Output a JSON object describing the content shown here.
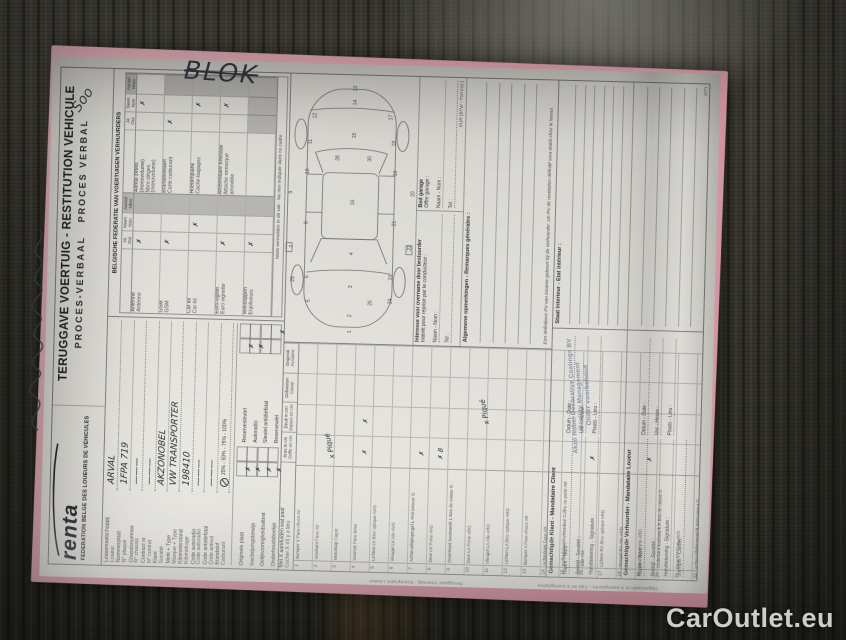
{
  "watermark": "CarOutlet.eu",
  "margin_notes": {
    "blok": "BLOK",
    "soo": "Soo"
  },
  "header": {
    "logo": "renta",
    "federation": "FEDERATION BELGE DES LOUEURS DE VÉHICULES",
    "title": "TERUGGAVE VOERTUIG - RESTITUTION VEHICULE",
    "subtitle_nl": "PROCES-VERBAAL",
    "subtitle_fr": "PROCES VERBAL"
  },
  "vehicle_fields": [
    {
      "nl": "Leasemaatschappij",
      "fr": "Loueur",
      "value": "ARVAL"
    },
    {
      "nl": "Nummerplaat",
      "fr": "N° plaque",
      "value": "1FPA 719"
    },
    {
      "nl": "Chassisnummer",
      "fr": "N° chassis",
      "value": "———"
    },
    {
      "nl": "Contract nr",
      "fr": "N° contrat",
      "value": "———"
    },
    {
      "nl": "Klant",
      "fr": "Société",
      "value": "AKZONOBEL"
    },
    {
      "nl": "Merk + Type",
      "fr": "Marque + Type",
      "value": "VW TRANSPORTER"
    },
    {
      "nl": "Kilometerstand",
      "fr": "Kilométrage",
      "value": "198410"
    },
    {
      "nl": "Code autoradio",
      "fr": "Code autoradio",
      "value": "———"
    },
    {
      "nl": "Code antidiefstal",
      "fr": "Code antivol",
      "value": "———"
    },
    {
      "nl": "Brandstof",
      "fr": "Carburant",
      "value": "",
      "fuel": "25% - 50% - 75% - 100%"
    }
  ],
  "documents": {
    "items": [
      {
        "nl": "Originele plaat",
        "fr": "Plaque officielle",
        "ja": "✗",
        "neen": ""
      },
      {
        "nl": "Inschrijvingsbewijs",
        "fr": "Cert. d'immatriculation",
        "ja": "✗",
        "neen": ""
      },
      {
        "nl": "Gelijkvormigheidsattest",
        "fr": "Certif. de conformité",
        "ja": "✗",
        "neen": ""
      },
      {
        "nl": "Onderhoudsboekje",
        "fr": "Carnet d'entretien",
        "ja": "✗",
        "neen": ""
      },
      {
        "nl": "Reservesleutel",
        "fr": "Clé de réserve",
        "ja": "✗",
        "neen": ""
      },
      {
        "nl": "Autoradio",
        "fr": "Autoradio",
        "ja": "✗",
        "neen": ""
      },
      {
        "nl": "Sleutel antidiefstal",
        "fr": "Clé antivol",
        "ja": "",
        "neen": ""
      },
      {
        "nl": "Reservewiel",
        "fr": "Roue de réserve",
        "ja": "",
        "neen": "✗"
      }
    ]
  },
  "federation": {
    "title": "BELGISCHE FEDERATIE VAN VOERTUIGEN VERHUURDERS",
    "ja": "Ja",
    "oui": "Oui",
    "neen": "Neen",
    "non": "Non",
    "aantal": "Aantal",
    "nbre": "Nbre",
    "group_a": [
      {
        "nl": "Antenne",
        "fr": "Antenne",
        "ja": "✗",
        "neen": "",
        "aantal": "",
        "count": false
      },
      {
        "nl": "GSM",
        "fr": "GSM",
        "ja": "✗",
        "neen": "",
        "aantal": "",
        "count": false
      },
      {
        "nl": "Car kit",
        "fr": "Car kit",
        "ja": "",
        "neen": "✗",
        "aantal": "",
        "count": false
      },
      {
        "nl": "Euro-vignet",
        "fr": "Euro vignette",
        "ja": "✗",
        "neen": "",
        "aantal": "",
        "count": false
      },
      {
        "nl": "Wieldoppen",
        "fr": "Enjoliveurs",
        "ja": "✗",
        "neen": "",
        "aantal": "",
        "count": false
      }
    ],
    "group_b": [
      {
        "nl": "Aantal zetels (monovolume)",
        "fr": "Nbre sièges (monovolume)",
        "ja": "",
        "neen": "✗",
        "aantal": "",
        "count": true
      },
      {
        "nl": "Brandstofkaart",
        "fr": "Carte carburant",
        "ja": "✗",
        "neen": "",
        "aantal": "",
        "count": false
      },
      {
        "nl": "Hoedenplank",
        "fr": "Cache-bagages",
        "ja": "",
        "neen": "✗",
        "aantal": "",
        "count": false
      },
      {
        "nl": "Afneembare trekhaak",
        "fr": "Attache remorque amovible",
        "ja": "",
        "neen": "✗",
        "aantal": "",
        "count": false
      }
    ],
    "note": "Niets vermelden in dit vak - Ne rien indiquer dans ce cadre"
  },
  "damage": {
    "instruction_nl": "Met X aanduiden wat past",
    "instruction_fr": "Cocher X s'il y a lieu",
    "cols": [
      {
        "nl": "Kras in cm",
        "fr": "Griffe en cm"
      },
      {
        "nl": "Deuk in cm",
        "fr": "Impact en cm"
      },
      {
        "nl": "Gebarsten",
        "fr": "Cassé"
      },
      {
        "nl": "Ongeval",
        "fr": "Accident"
      }
    ],
    "note_windshield": "x Piqué",
    "note_mirror": "x Piqué",
    "rows": [
      {
        "n": "1",
        "nl": "Bumper V",
        "fr": "Pare-chocs AV",
        "m": [
          "",
          "",
          "",
          ""
        ]
      },
      {
        "n": "2",
        "nl": "Voorkant",
        "fr": "Face AV",
        "m": [
          "",
          "",
          "",
          ""
        ]
      },
      {
        "n": "3",
        "nl": "Motorkap",
        "fr": "Capot",
        "m": [
          "",
          "",
          "",
          ""
        ]
      },
      {
        "n": "4",
        "nl": "Voorruit",
        "fr": "Pare-brise",
        "m": [
          "✗",
          "✗",
          "",
          ""
        ]
      },
      {
        "n": "5",
        "nl": "Lichten LV",
        "fr": "Bloc optique AVG",
        "m": [
          "",
          "",
          "",
          ""
        ]
      },
      {
        "n": "6",
        "nl": "Vleugel LV",
        "fr": "Aile AVG",
        "m": [
          "",
          "",
          "",
          ""
        ]
      },
      {
        "n": "7",
        "nl": "Achteruitkijkspiegel L",
        "fr": "Rétroviseur G",
        "m": [
          "✗",
          "",
          "",
          ""
        ]
      },
      {
        "n": "8",
        "nl": "Deur LV",
        "fr": "Porte AVG",
        "m": [
          "✗ B",
          "",
          "",
          ""
        ]
      },
      {
        "n": "9",
        "nl": "Onderkant koetswerk L",
        "fr": "Bas de caisse G",
        "m": [
          "",
          "",
          "",
          ""
        ]
      },
      {
        "n": "10",
        "nl": "Deur LA",
        "fr": "Porte ARG",
        "m": [
          "",
          "",
          "",
          ""
        ]
      },
      {
        "n": "11",
        "nl": "Vleugel LA",
        "fr": "Aile ARG",
        "m": [
          "",
          "",
          "",
          ""
        ]
      },
      {
        "n": "12",
        "nl": "Lichten LA",
        "fr": "Bloc optique ARG",
        "m": [
          "",
          "",
          "",
          ""
        ]
      },
      {
        "n": "13",
        "nl": "Bumper A",
        "fr": "Pare-chocs AR",
        "m": [
          "",
          "",
          "",
          ""
        ]
      },
      {
        "n": "14",
        "nl": "Achterkant",
        "fr": "Face AR",
        "m": [
          "",
          "",
          "",
          ""
        ]
      },
      {
        "n": "15",
        "nl": "Kofferdeksel/Achterdeur",
        "fr": "Coffre ou porte AR",
        "m": [
          "",
          "",
          "",
          ""
        ]
      },
      {
        "n": "16",
        "nl": "Dak",
        "fr": "Toit",
        "m": [
          "✗",
          "",
          "",
          ""
        ]
      },
      {
        "n": "17",
        "nl": "Lichten RA",
        "fr": "Bloc optique ARD",
        "m": [
          "",
          "",
          "",
          ""
        ]
      },
      {
        "n": "18",
        "nl": "Vleugel RA",
        "fr": "Aile ARD",
        "m": [
          "",
          "",
          "",
          ""
        ]
      },
      {
        "n": "19",
        "nl": "Deur RA",
        "fr": "Porte ARD",
        "m": [
          "✗",
          "",
          "",
          ""
        ]
      },
      {
        "n": "20",
        "nl": "Onderkant koetswerk R",
        "fr": "Bas de caisse D",
        "m": [
          "",
          "",
          "",
          ""
        ]
      },
      {
        "n": "21",
        "nl": "Deur RV",
        "fr": "Porte AVD",
        "m": [
          "",
          "",
          "",
          ""
        ]
      },
      {
        "n": "22",
        "nl": "Achteruitkijkspiegel R",
        "fr": "Rétroviseur D",
        "m": [
          "✗",
          "",
          "",
          ""
        ]
      },
      {
        "n": "23",
        "nl": "Vleugel RV",
        "fr": "Aile AVD",
        "m": [
          "",
          "",
          "",
          ""
        ]
      },
      {
        "n": "24",
        "nl": "Lichten RV",
        "fr": "Bloc optique AVD",
        "m": [
          "",
          "",
          "",
          ""
        ]
      },
      {
        "n": "25",
        "nl": "Wieldeksels/Velgen",
        "fr": "Enjoliveurs/Jantes",
        "m": [
          "✗",
          "",
          "",
          ""
        ]
      },
      {
        "n": "26",
        "nl": "Mistlampen V",
        "fr": "Phares antibrouillard AV",
        "m": [
          "",
          "",
          "",
          ""
        ]
      }
    ]
  },
  "boxes": {
    "interest": {
      "title_nl": "Interesse voor overname door bestuurder",
      "title_fr": "Intérêt pour reprise par le conducteur :",
      "naam": "Naam - Nom :",
      "tel": "Tel :"
    },
    "garage": {
      "title_nl": "Bod garage",
      "title_fr": "Offre garage :",
      "naam": "Naam - Nom :",
      "tel": "Tel :",
      "eur": "EUR (BTW - TVA incl.)"
    },
    "remarks_title": "Algemene opmerkingen - Remarques générales :",
    "pv_note_nl": "Een definitieve PV van inname gebeurt bij de verhuurder.",
    "pv_note_fr": "Un PV de restitution définitif sera établi chez le loueur.",
    "interior_title": "Staat interieur - Etat intérieur :"
  },
  "signatures": {
    "client": {
      "title": "Gemachtigde Klant - Mandataire Client",
      "naam": "Naam - Nom :",
      "bedrijf": "Bedrijf - Société :",
      "handtekening": "Handtekening - Signature :",
      "datum": "Datum - Date :",
      "uur": "Uur - Heure :",
      "plaats": "Plaats - Lieu :",
      "stamp": [
        "Akzo Nobel Decorative Coatings BV",
        "Facility Management",
        "Onder voorbehoud"
      ]
    },
    "lessor": {
      "title": "Gemachtigde Verhuurder - Mandataire Loueur",
      "naam": "Naam - Nom :",
      "bedrijf": "Bedrijf - Société :",
      "handtekening": "Handtekening - Signature :",
      "stempel": "Stempel - Cachet :",
      "datum": "Datum - Date :",
      "uur": "Uur - Heure :",
      "plaats": "Plaats - Lieu :"
    }
  },
  "footer": {
    "edge1": "Teruggave Voertuig - Exemplaire Loueur",
    "edge2": "Opgemaakt in 4 exemplaren - Fait en 4 exemplaires",
    "code": "1071"
  },
  "diagram": {
    "numbers": [
      {
        "n": "1",
        "x": 10,
        "y": 72
      },
      {
        "n": "2",
        "x": 26,
        "y": 72
      },
      {
        "n": "26",
        "x": 38,
        "y": 92
      },
      {
        "n": "3",
        "x": 55,
        "y": 72
      },
      {
        "n": "5",
        "x": 40,
        "y": 30
      },
      {
        "n": "24",
        "x": 40,
        "y": 112
      },
      {
        "n": "6",
        "x": 64,
        "y": 28
      },
      {
        "n": "23",
        "x": 64,
        "y": 112
      },
      {
        "n": "4",
        "x": 88,
        "y": 72
      },
      {
        "n": "7",
        "x": 94,
        "y": 12
      },
      {
        "n": "22",
        "x": 94,
        "y": 130
      },
      {
        "n": "8",
        "x": 118,
        "y": 26
      },
      {
        "n": "21",
        "x": 118,
        "y": 114
      },
      {
        "n": "9",
        "x": 148,
        "y": 10
      },
      {
        "n": "20",
        "x": 148,
        "y": 132
      },
      {
        "n": "10",
        "x": 168,
        "y": 26
      },
      {
        "n": "19",
        "x": 168,
        "y": 114
      },
      {
        "n": "16",
        "x": 138,
        "y": 72
      },
      {
        "n": "28",
        "x": 182,
        "y": 56
      },
      {
        "n": "30",
        "x": 182,
        "y": 88
      },
      {
        "n": "11",
        "x": 198,
        "y": 28
      },
      {
        "n": "18",
        "x": 198,
        "y": 112
      },
      {
        "n": "12",
        "x": 224,
        "y": 32
      },
      {
        "n": "17",
        "x": 224,
        "y": 108
      },
      {
        "n": "15",
        "x": 205,
        "y": 72
      },
      {
        "n": "14",
        "x": 238,
        "y": 72
      },
      {
        "n": "13",
        "x": 252,
        "y": 72
      },
      {
        "n": "25",
        "x": 60,
        "y": 14
      }
    ]
  }
}
